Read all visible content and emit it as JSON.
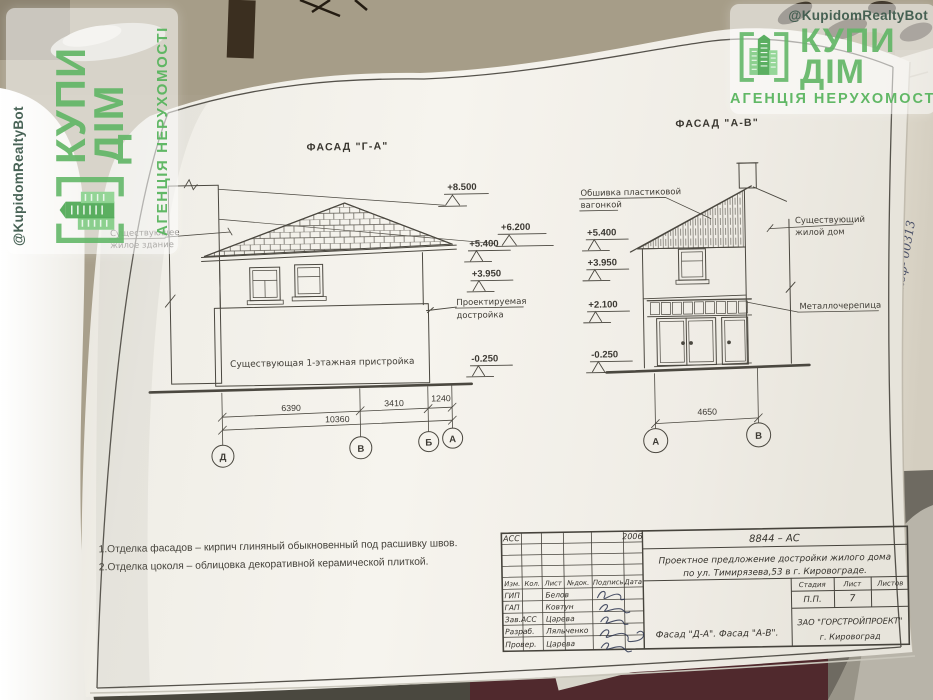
{
  "watermark": {
    "handle": "@KupidomRealtyBot",
    "brand_word1": "КУПИ",
    "brand_word2": "ДІМ",
    "tagline": "АГЕНЦІЯ НЕРУХОМОСТІ"
  },
  "sheet": {
    "facade_left": {
      "title": "ФАСАД \"Г-А\"",
      "label_existing_1": "Существующее",
      "label_existing_2": "жилое здание",
      "label_annex": "Существующая 1-этажная пристройка",
      "label_proposed_1": "Проектируемая",
      "label_proposed_2": "достройка",
      "elev_8500": "+8.500",
      "elev_6200": "+6.200",
      "elev_5400": "+5.400",
      "elev_3950": "+3.950",
      "elev_m0250": "-0.250",
      "dim_6390": "6390",
      "dim_3410": "3410",
      "dim_1240": "1240",
      "dim_total": "10360",
      "axis_d": "Д",
      "axis_v": "В",
      "axis_b": "Б",
      "axis_a": "А"
    },
    "facade_right": {
      "title": "ФАСАД \"А-В\"",
      "label_siding_1": "Обшивка пластиковой",
      "label_siding_2": "вагонкой",
      "label_house_1": "Существующий",
      "label_house_2": "жилой дом",
      "label_metal": "Металлочерепица",
      "elev_5400": "+5.400",
      "elev_3950": "+3.950",
      "elev_2100": "+2.100",
      "elev_m0250": "-0.250",
      "dim_4650": "4650",
      "axis_a": "А",
      "axis_v": "В"
    },
    "notes_1": "1.Отделка фасадов – кирпич глиняный обыкновенный под расшивку швов.",
    "notes_2": "2.Отделка цоколя – облицовка декоративной керамической плиткой.",
    "titleblock": {
      "code": "АСС",
      "year": "2006",
      "doc": "8844 – АС",
      "project_1": "Проектное предложение достройки жилого дома",
      "project_2": "по ул. Тимирязева,53 в г. Кировограде.",
      "col_izm": "Изм.",
      "col_kol": "Кол.",
      "col_list": "Лист",
      "col_ndok": "№док.",
      "col_podpis": "Подпись",
      "col_data": "Дата",
      "r1_role": "ГИП",
      "r1_name": "Белов",
      "r2_role": "ГАП",
      "r2_name": "Ковтун",
      "r3_role": "Зав.АСС",
      "r3_name": "Царева",
      "r4_role": "Разраб.",
      "r4_name": "Ляльченко",
      "r5_role": "Провер.",
      "r5_name": "Царева",
      "h_stage": "Стадия",
      "h_list": "Лист",
      "h_listov": "Листов",
      "stage": "П.П.",
      "list_no": "7",
      "sheet_title": "Фасад \"Д-А\". Фасад \"А-В\".",
      "org_1": "ЗАО \"ГОРСТРОЙПРОЕКТ\"",
      "org_2": "г. Кировоград"
    },
    "handwriting": "коф- 00313"
  }
}
